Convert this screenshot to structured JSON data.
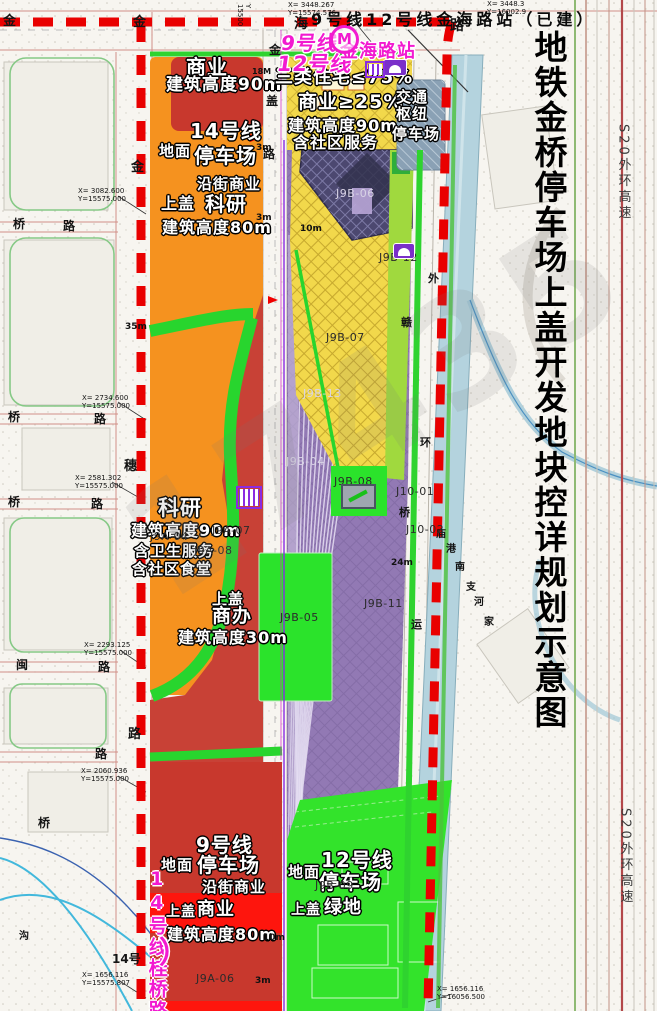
{
  "title": {
    "text": "地铁金桥停车场上盖开发地块控详规划示意图"
  },
  "top_caption": {
    "text": "9号线12号线金海路站（已建）"
  },
  "station_badge": {
    "m": "M"
  },
  "watermark": {
    "text": "17435"
  },
  "colors": {
    "boundary_red": "#e90000",
    "orange": "#f5921f",
    "brick_red": "#c8382d",
    "bright_red": "#fe150d",
    "yellow": "#f2d84b",
    "purple": "#9279b4",
    "navy": "#4c4870",
    "green": "#2fd32f",
    "bright_green": "#33e32b",
    "canal_blue": "#b4d3de",
    "hub_blue": "#8aa1b5",
    "magenta": "#f21ad0"
  },
  "labels": [
    {
      "t": "商业",
      "x": 186,
      "y": 57,
      "fs": 20,
      "c": "z"
    },
    {
      "t": "建筑高度90m",
      "x": 166,
      "y": 77,
      "fs": 17,
      "c": "z"
    },
    {
      "t": "14号线",
      "x": 190,
      "y": 121,
      "fs": 20,
      "c": "z"
    },
    {
      "t": "地面",
      "x": 159,
      "y": 144,
      "fs": 15,
      "c": "z"
    },
    {
      "t": "停车场",
      "x": 194,
      "y": 146,
      "fs": 20,
      "c": "z"
    },
    {
      "t": "沿街商业",
      "x": 197,
      "y": 177,
      "fs": 15,
      "c": "z"
    },
    {
      "t": "上盖",
      "x": 161,
      "y": 196,
      "fs": 16,
      "c": "z"
    },
    {
      "t": "科研",
      "x": 205,
      "y": 194,
      "fs": 20,
      "c": "z"
    },
    {
      "t": "建筑高度80m",
      "x": 162,
      "y": 220,
      "fs": 16,
      "c": "z"
    },
    {
      "t": "三类住宅≤75%",
      "x": 275,
      "y": 69,
      "fs": 18,
      "c": "z"
    },
    {
      "t": "商业≥25%",
      "x": 298,
      "y": 93,
      "fs": 19,
      "c": "z"
    },
    {
      "t": "建筑高度90m",
      "x": 288,
      "y": 118,
      "fs": 16,
      "c": "z"
    },
    {
      "t": "含社区服务",
      "x": 293,
      "y": 135,
      "fs": 16,
      "c": "z"
    },
    {
      "t": "交通",
      "x": 396,
      "y": 90,
      "fs": 15,
      "c": "z"
    },
    {
      "t": "枢纽",
      "x": 396,
      "y": 107,
      "fs": 15,
      "c": "z"
    },
    {
      "t": "停车场",
      "x": 392,
      "y": 127,
      "fs": 15,
      "c": "z"
    },
    {
      "t": "科研",
      "x": 158,
      "y": 498,
      "fs": 21,
      "c": "z"
    },
    {
      "t": "建筑高度90m",
      "x": 131,
      "y": 523,
      "fs": 16,
      "c": "z"
    },
    {
      "t": "含卫生服务",
      "x": 134,
      "y": 544,
      "fs": 15,
      "c": "z"
    },
    {
      "t": "含社区食堂",
      "x": 132,
      "y": 562,
      "fs": 15,
      "c": "z"
    },
    {
      "t": "上盖",
      "x": 212,
      "y": 592,
      "fs": 15,
      "c": "z"
    },
    {
      "t": "商办",
      "x": 212,
      "y": 607,
      "fs": 19,
      "c": "z"
    },
    {
      "t": "建筑高度30m",
      "x": 178,
      "y": 630,
      "fs": 16,
      "c": "z"
    },
    {
      "t": "9号线",
      "x": 196,
      "y": 835,
      "fs": 20,
      "c": "z"
    },
    {
      "t": "地面",
      "x": 161,
      "y": 858,
      "fs": 15,
      "c": "z"
    },
    {
      "t": "停车场",
      "x": 197,
      "y": 855,
      "fs": 20,
      "c": "z"
    },
    {
      "t": "沿街商业",
      "x": 202,
      "y": 880,
      "fs": 15,
      "c": "z"
    },
    {
      "t": "上盖",
      "x": 166,
      "y": 905,
      "fs": 14,
      "c": "z"
    },
    {
      "t": "商业",
      "x": 197,
      "y": 901,
      "fs": 18,
      "c": "z"
    },
    {
      "t": "建筑高度80m",
      "x": 167,
      "y": 927,
      "fs": 16,
      "c": "z"
    },
    {
      "t": "地面",
      "x": 288,
      "y": 865,
      "fs": 15,
      "c": "z"
    },
    {
      "t": "12号线",
      "x": 321,
      "y": 850,
      "fs": 20,
      "c": "z"
    },
    {
      "t": "停车场",
      "x": 319,
      "y": 872,
      "fs": 20,
      "c": "z"
    },
    {
      "t": "上盖",
      "x": 291,
      "y": 903,
      "fs": 14,
      "c": "z"
    },
    {
      "t": "绿地",
      "x": 324,
      "y": 899,
      "fs": 18,
      "c": "z"
    },
    {
      "t": "9号线",
      "x": 281,
      "y": 33,
      "fs": 20,
      "c": "m sk"
    },
    {
      "t": "12号线",
      "x": 277,
      "y": 54,
      "fs": 21,
      "c": "m sk"
    },
    {
      "t": "金海路站",
      "x": 340,
      "y": 43,
      "fs": 18,
      "c": "m"
    },
    {
      "t": "14号线桂桥路",
      "x": 146,
      "y": 868,
      "fs": 19,
      "c": "mv"
    },
    {
      "t": "）",
      "x": 159,
      "y": 938,
      "fs": 30,
      "c": "m"
    },
    {
      "t": "金",
      "x": 3,
      "y": 15,
      "fs": 13,
      "c": "k"
    },
    {
      "t": "金",
      "x": 133,
      "y": 16,
      "fs": 13,
      "c": "k"
    },
    {
      "t": "海",
      "x": 294,
      "y": 17,
      "fs": 14,
      "c": "k"
    },
    {
      "t": "路",
      "x": 450,
      "y": 19,
      "fs": 14,
      "c": "k"
    },
    {
      "t": "金",
      "x": 131,
      "y": 161,
      "fs": 13,
      "c": "k"
    },
    {
      "t": "穗",
      "x": 124,
      "y": 460,
      "fs": 13,
      "c": "k"
    },
    {
      "t": "路",
      "x": 128,
      "y": 728,
      "fs": 13,
      "c": "k"
    },
    {
      "t": "桥",
      "x": 13,
      "y": 218,
      "fs": 12,
      "c": "k"
    },
    {
      "t": "路",
      "x": 63,
      "y": 220,
      "fs": 12,
      "c": "k"
    },
    {
      "t": "桥",
      "x": 8,
      "y": 411,
      "fs": 12,
      "c": "k"
    },
    {
      "t": "路",
      "x": 94,
      "y": 413,
      "fs": 12,
      "c": "k"
    },
    {
      "t": "桥",
      "x": 8,
      "y": 496,
      "fs": 12,
      "c": "k"
    },
    {
      "t": "路",
      "x": 91,
      "y": 498,
      "fs": 12,
      "c": "k"
    },
    {
      "t": "闽",
      "x": 16,
      "y": 659,
      "fs": 12,
      "c": "k"
    },
    {
      "t": "路",
      "x": 98,
      "y": 661,
      "fs": 12,
      "c": "k"
    },
    {
      "t": "路",
      "x": 95,
      "y": 748,
      "fs": 12,
      "c": "k"
    },
    {
      "t": "桥",
      "x": 38,
      "y": 817,
      "fs": 12,
      "c": "k"
    },
    {
      "t": "金",
      "x": 269,
      "y": 44,
      "fs": 12,
      "c": "k"
    },
    {
      "t": "盖",
      "x": 266,
      "y": 95,
      "fs": 12,
      "c": "k"
    },
    {
      "t": "路",
      "x": 263,
      "y": 148,
      "fs": 12,
      "c": "k"
    },
    {
      "t": "外",
      "x": 428,
      "y": 273,
      "fs": 11,
      "c": "k"
    },
    {
      "t": "赣",
      "x": 401,
      "y": 317,
      "fs": 11,
      "c": "k"
    },
    {
      "t": "环",
      "x": 420,
      "y": 437,
      "fs": 11,
      "c": "k"
    },
    {
      "t": "桥",
      "x": 399,
      "y": 507,
      "fs": 11,
      "c": "k"
    },
    {
      "t": "运",
      "x": 411,
      "y": 619,
      "fs": 11,
      "c": "k"
    },
    {
      "t": "沟",
      "x": 19,
      "y": 932,
      "fs": 10,
      "c": "k"
    },
    {
      "t": "庙",
      "x": 436,
      "y": 530,
      "fs": 10,
      "c": "k"
    },
    {
      "t": "港",
      "x": 446,
      "y": 545,
      "fs": 10,
      "c": "k"
    },
    {
      "t": "南",
      "x": 455,
      "y": 563,
      "fs": 10,
      "c": "k"
    },
    {
      "t": "支",
      "x": 466,
      "y": 583,
      "fs": 10,
      "c": "k"
    },
    {
      "t": "河",
      "x": 474,
      "y": 598,
      "fs": 10,
      "c": "k"
    },
    {
      "t": "家",
      "x": 484,
      "y": 618,
      "fs": 10,
      "c": "k"
    },
    {
      "t": "14号",
      "x": 112,
      "y": 953,
      "fs": 12,
      "c": "k"
    },
    {
      "t": "J9A-04",
      "x": 150,
      "y": 531,
      "fs": 11,
      "c": "p"
    },
    {
      "t": "J9A-07",
      "x": 212,
      "y": 525,
      "fs": 11,
      "c": "p"
    },
    {
      "t": "J9A-08",
      "x": 194,
      "y": 545,
      "fs": 11,
      "c": "p"
    },
    {
      "t": "J9A-06",
      "x": 196,
      "y": 973,
      "fs": 11,
      "c": "p"
    },
    {
      "t": "J9B-04",
      "x": 286,
      "y": 456,
      "fs": 11,
      "c": "pl"
    },
    {
      "t": "J9B-05",
      "x": 280,
      "y": 612,
      "fs": 11,
      "c": "p"
    },
    {
      "t": "J9B-06",
      "x": 336,
      "y": 188,
      "fs": 11,
      "c": "pl"
    },
    {
      "t": "J9B-07",
      "x": 326,
      "y": 332,
      "fs": 11,
      "c": "p"
    },
    {
      "t": "J9B-08",
      "x": 334,
      "y": 476,
      "fs": 11,
      "c": "p"
    },
    {
      "t": "J9B-09",
      "x": 315,
      "y": 880,
      "fs": 11,
      "c": "p"
    },
    {
      "t": "J9B-11",
      "x": 364,
      "y": 598,
      "fs": 11,
      "c": "p"
    },
    {
      "t": "J9B-12",
      "x": 379,
      "y": 252,
      "fs": 11,
      "c": "p"
    },
    {
      "t": "J9B-13",
      "x": 303,
      "y": 388,
      "fs": 11,
      "c": "pl"
    },
    {
      "t": "J10-01",
      "x": 396,
      "y": 486,
      "fs": 11,
      "c": "p"
    },
    {
      "t": "J10-02",
      "x": 406,
      "y": 524,
      "fs": 11,
      "c": "p"
    },
    {
      "t": "X= 3448.267\nY=15574.576",
      "x": 288,
      "y": 1,
      "fs": 7,
      "c": "c7"
    },
    {
      "t": "X= 3448.3\nY=16002.9",
      "x": 487,
      "y": 0,
      "fs": 7,
      "c": "c7"
    },
    {
      "t": "Y 15500",
      "x": 252,
      "y": 4,
      "fs": 7,
      "c": "c7",
      "r": 90
    },
    {
      "t": "X= 3082.600\nY=15575.000",
      "x": 78,
      "y": 187,
      "fs": 7,
      "c": "c7"
    },
    {
      "t": "X= 2734.600\nY=15575.000",
      "x": 82,
      "y": 394,
      "fs": 7,
      "c": "c7"
    },
    {
      "t": "X= 2581.302\nY=15575.000",
      "x": 75,
      "y": 474,
      "fs": 7,
      "c": "c7"
    },
    {
      "t": "X= 2293.125\nY=15575.000",
      "x": 84,
      "y": 641,
      "fs": 7,
      "c": "c7"
    },
    {
      "t": "X= 2060.936\nY=15575.000",
      "x": 81,
      "y": 767,
      "fs": 7,
      "c": "c7"
    },
    {
      "t": "X= 1656.116\nY=15575.807",
      "x": 82,
      "y": 971,
      "fs": 7,
      "c": "c7"
    },
    {
      "t": "X= 1656.116\nY=16056.500",
      "x": 437,
      "y": 985,
      "fs": 7,
      "c": "c7"
    },
    {
      "t": "35m",
      "x": 125,
      "y": 323,
      "fs": 9,
      "c": "d"
    },
    {
      "t": "24m",
      "x": 391,
      "y": 559,
      "fs": 9,
      "c": "d"
    },
    {
      "t": "10m",
      "x": 300,
      "y": 225,
      "fs": 9,
      "c": "d"
    },
    {
      "t": "3m",
      "x": 256,
      "y": 214,
      "fs": 9,
      "c": "d"
    },
    {
      "t": "3m",
      "x": 256,
      "y": 144,
      "fs": 9,
      "c": "d"
    },
    {
      "t": "18M",
      "x": 252,
      "y": 68,
      "fs": 8,
      "c": "d"
    },
    {
      "t": "10m",
      "x": 263,
      "y": 934,
      "fs": 9,
      "c": "d"
    },
    {
      "t": "3m",
      "x": 255,
      "y": 977,
      "fs": 9,
      "c": "d"
    },
    {
      "t": "S20外环高速",
      "x": 616,
      "y": 124,
      "fs": 13,
      "c": "s"
    },
    {
      "t": "S20外环高速",
      "x": 618,
      "y": 808,
      "fs": 13,
      "c": "s"
    }
  ]
}
